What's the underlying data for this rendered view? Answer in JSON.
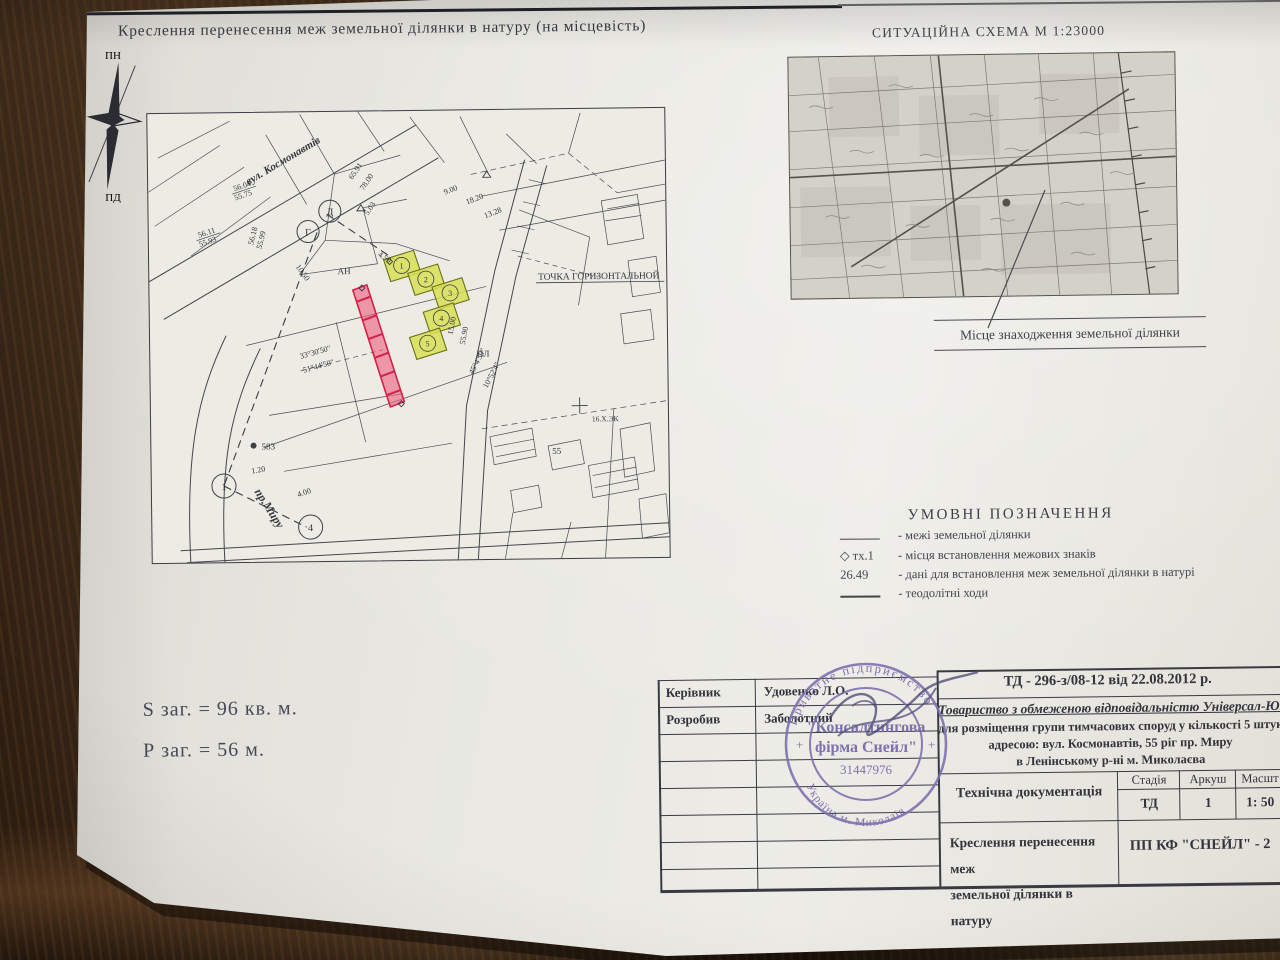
{
  "title": "Креслення перенесення меж земельної ділянки в натуру (на місцевість)",
  "compass": {
    "n": "ПН",
    "s": "ПД",
    "w": "З",
    "e": "С"
  },
  "situation": {
    "title": "СИТУАЦІЙНА СХЕМА  М 1:23000",
    "location_label": "Місце знаходження земельної ділянки"
  },
  "legend": {
    "title": "УМОВНІ  ПОЗНАЧЕННЯ",
    "rows": [
      {
        "symbol": "",
        "text": "- межі земельної ділянки"
      },
      {
        "symbol": "◇ тх.1",
        "text": "- місця встановлення межових знаків"
      },
      {
        "symbol": "26.49",
        "text": "- дані для встановлення меж земельної ділянки в натурі"
      },
      {
        "symbol": "",
        "text": "- теодолітні ходи"
      }
    ]
  },
  "totals": {
    "area": "S заг. = 96 кв. м.",
    "perimeter": "Р заг. = 56 м."
  },
  "title_block": {
    "doc_number": "ТД  -  296-з/08-12 від 22.08.2012 р.",
    "roles": [
      {
        "label": "Керівник",
        "name": "Удовенко Л.О."
      },
      {
        "label": "Розробив",
        "name": "Заболотний"
      }
    ],
    "company_line": "Товариство з обмеженою відповідальністю Універсал-ЮГ",
    "desc1": "для розміщення групи тимчасових споруд у кількості 5 штук, за",
    "desc2": "адресою: вул. Космонавтів, 55 ріг пр. Миру",
    "desc3": "в Ленінському р-ні м. Миколаєва",
    "doc_type": "Технічна документація",
    "stage_label": "Стадія",
    "sheet_label": "Аркуш",
    "scale_label": "Масшт",
    "stage": "ТД",
    "sheet": "1",
    "scale": "1: 50",
    "drawing_name1": "Креслення перенесення меж",
    "drawing_name2": "земельної ділянки в натуру",
    "firm": "ПП КФ \"СНЕЙЛ\" - 2"
  },
  "stamp": {
    "arc_top": "Приватне підприємство",
    "line1": "\"Консалтингова",
    "line2": "фірма Снейл\"",
    "code": "31447976",
    "arc_bottom": "Україна  м. Миколаїв",
    "plus": "+"
  },
  "map_labels": {
    "street1": "вул. Космонавтів",
    "street2": "пр.Миру",
    "point_note": "ТОЧКА ГОРИЗОНТАЛЬНОЙ",
    "elev1a": "56.04",
    "elev1b": "55.75",
    "elev2a": "56.11",
    "elev2b": "55.93",
    "elev3a": "56.18",
    "elev3b": "55.99",
    "d1": "65.91",
    "d2": "78.00",
    "d3": "5.03",
    "d4": "4.50",
    "d5": "18.20",
    "d6": "13.28",
    "d7": "9.00",
    "d8": "15.00",
    "d9": "55.90",
    "d10": "10.50",
    "ang1": "45°4'59\"",
    "ang2": "10°52'4\"",
    "ang3": "33°30'50\"",
    "ang4": "51°44'50\"",
    "m1": "1.20",
    "m2": "4.00",
    "pt583": "583",
    "pl": "ПЛ",
    "an": "АН",
    "n55": "55",
    "mark": "16.Х.ЭК",
    "c1": "Г",
    "c2": "Д",
    "c3": "1",
    "c4": "4",
    "p1": "1",
    "p2": "2",
    "p3": "3",
    "p4": "4",
    "p5": "5"
  },
  "colors": {
    "highlight_yellow": "#d8df55",
    "highlight_red": "#ef5d7e",
    "stamp_ink": "#6e62a6",
    "paper": "#e8e7e1",
    "desk": "#3a2a1a"
  }
}
